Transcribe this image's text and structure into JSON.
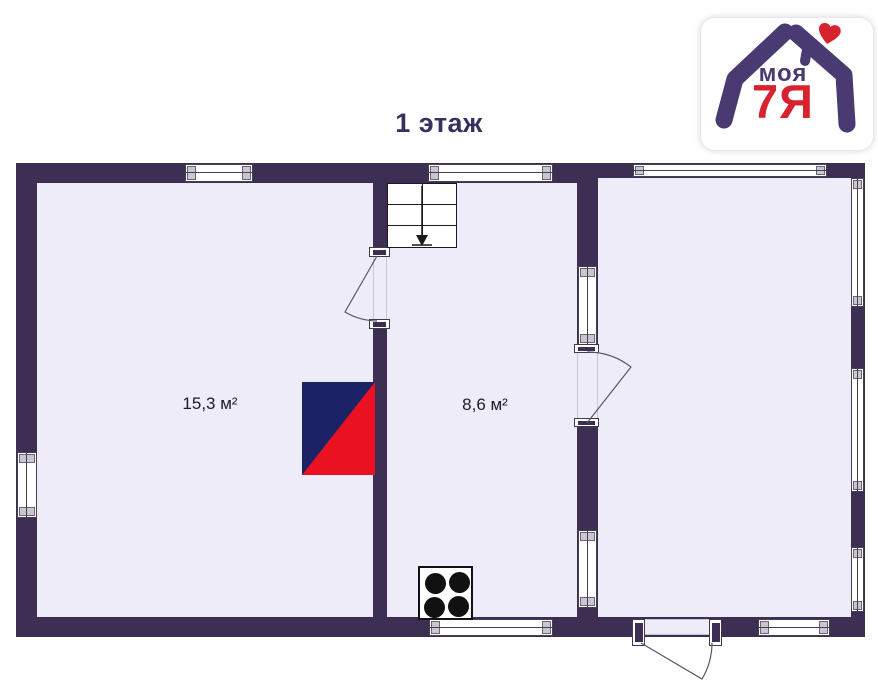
{
  "page": {
    "title": "1 этаж",
    "background": "#ffffff"
  },
  "logo": {
    "word_top": "моя",
    "word_bottom": "7Я",
    "heart": "♥"
  },
  "colors": {
    "wall": "#3d2f54",
    "floor": "#edecf8",
    "outline": "#45404f",
    "accent_red": "#ea1220",
    "accent_navy": "#1b2366",
    "logo_purple": "#4a3a72",
    "logo_red": "#d8232e",
    "title": "#373060"
  },
  "rooms": [
    {
      "id": "room-left",
      "area": "15,3 м²"
    },
    {
      "id": "room-middle",
      "area": "8,6 м²"
    },
    {
      "id": "room-right",
      "area": ""
    }
  ],
  "symbols": {
    "stairs": "stairs-with-down-arrow",
    "stove": "furnace-stove-symbol",
    "cooktop": "four-burner-cooktop",
    "doors": "door-swing-arc",
    "windows": "double-line-window"
  }
}
